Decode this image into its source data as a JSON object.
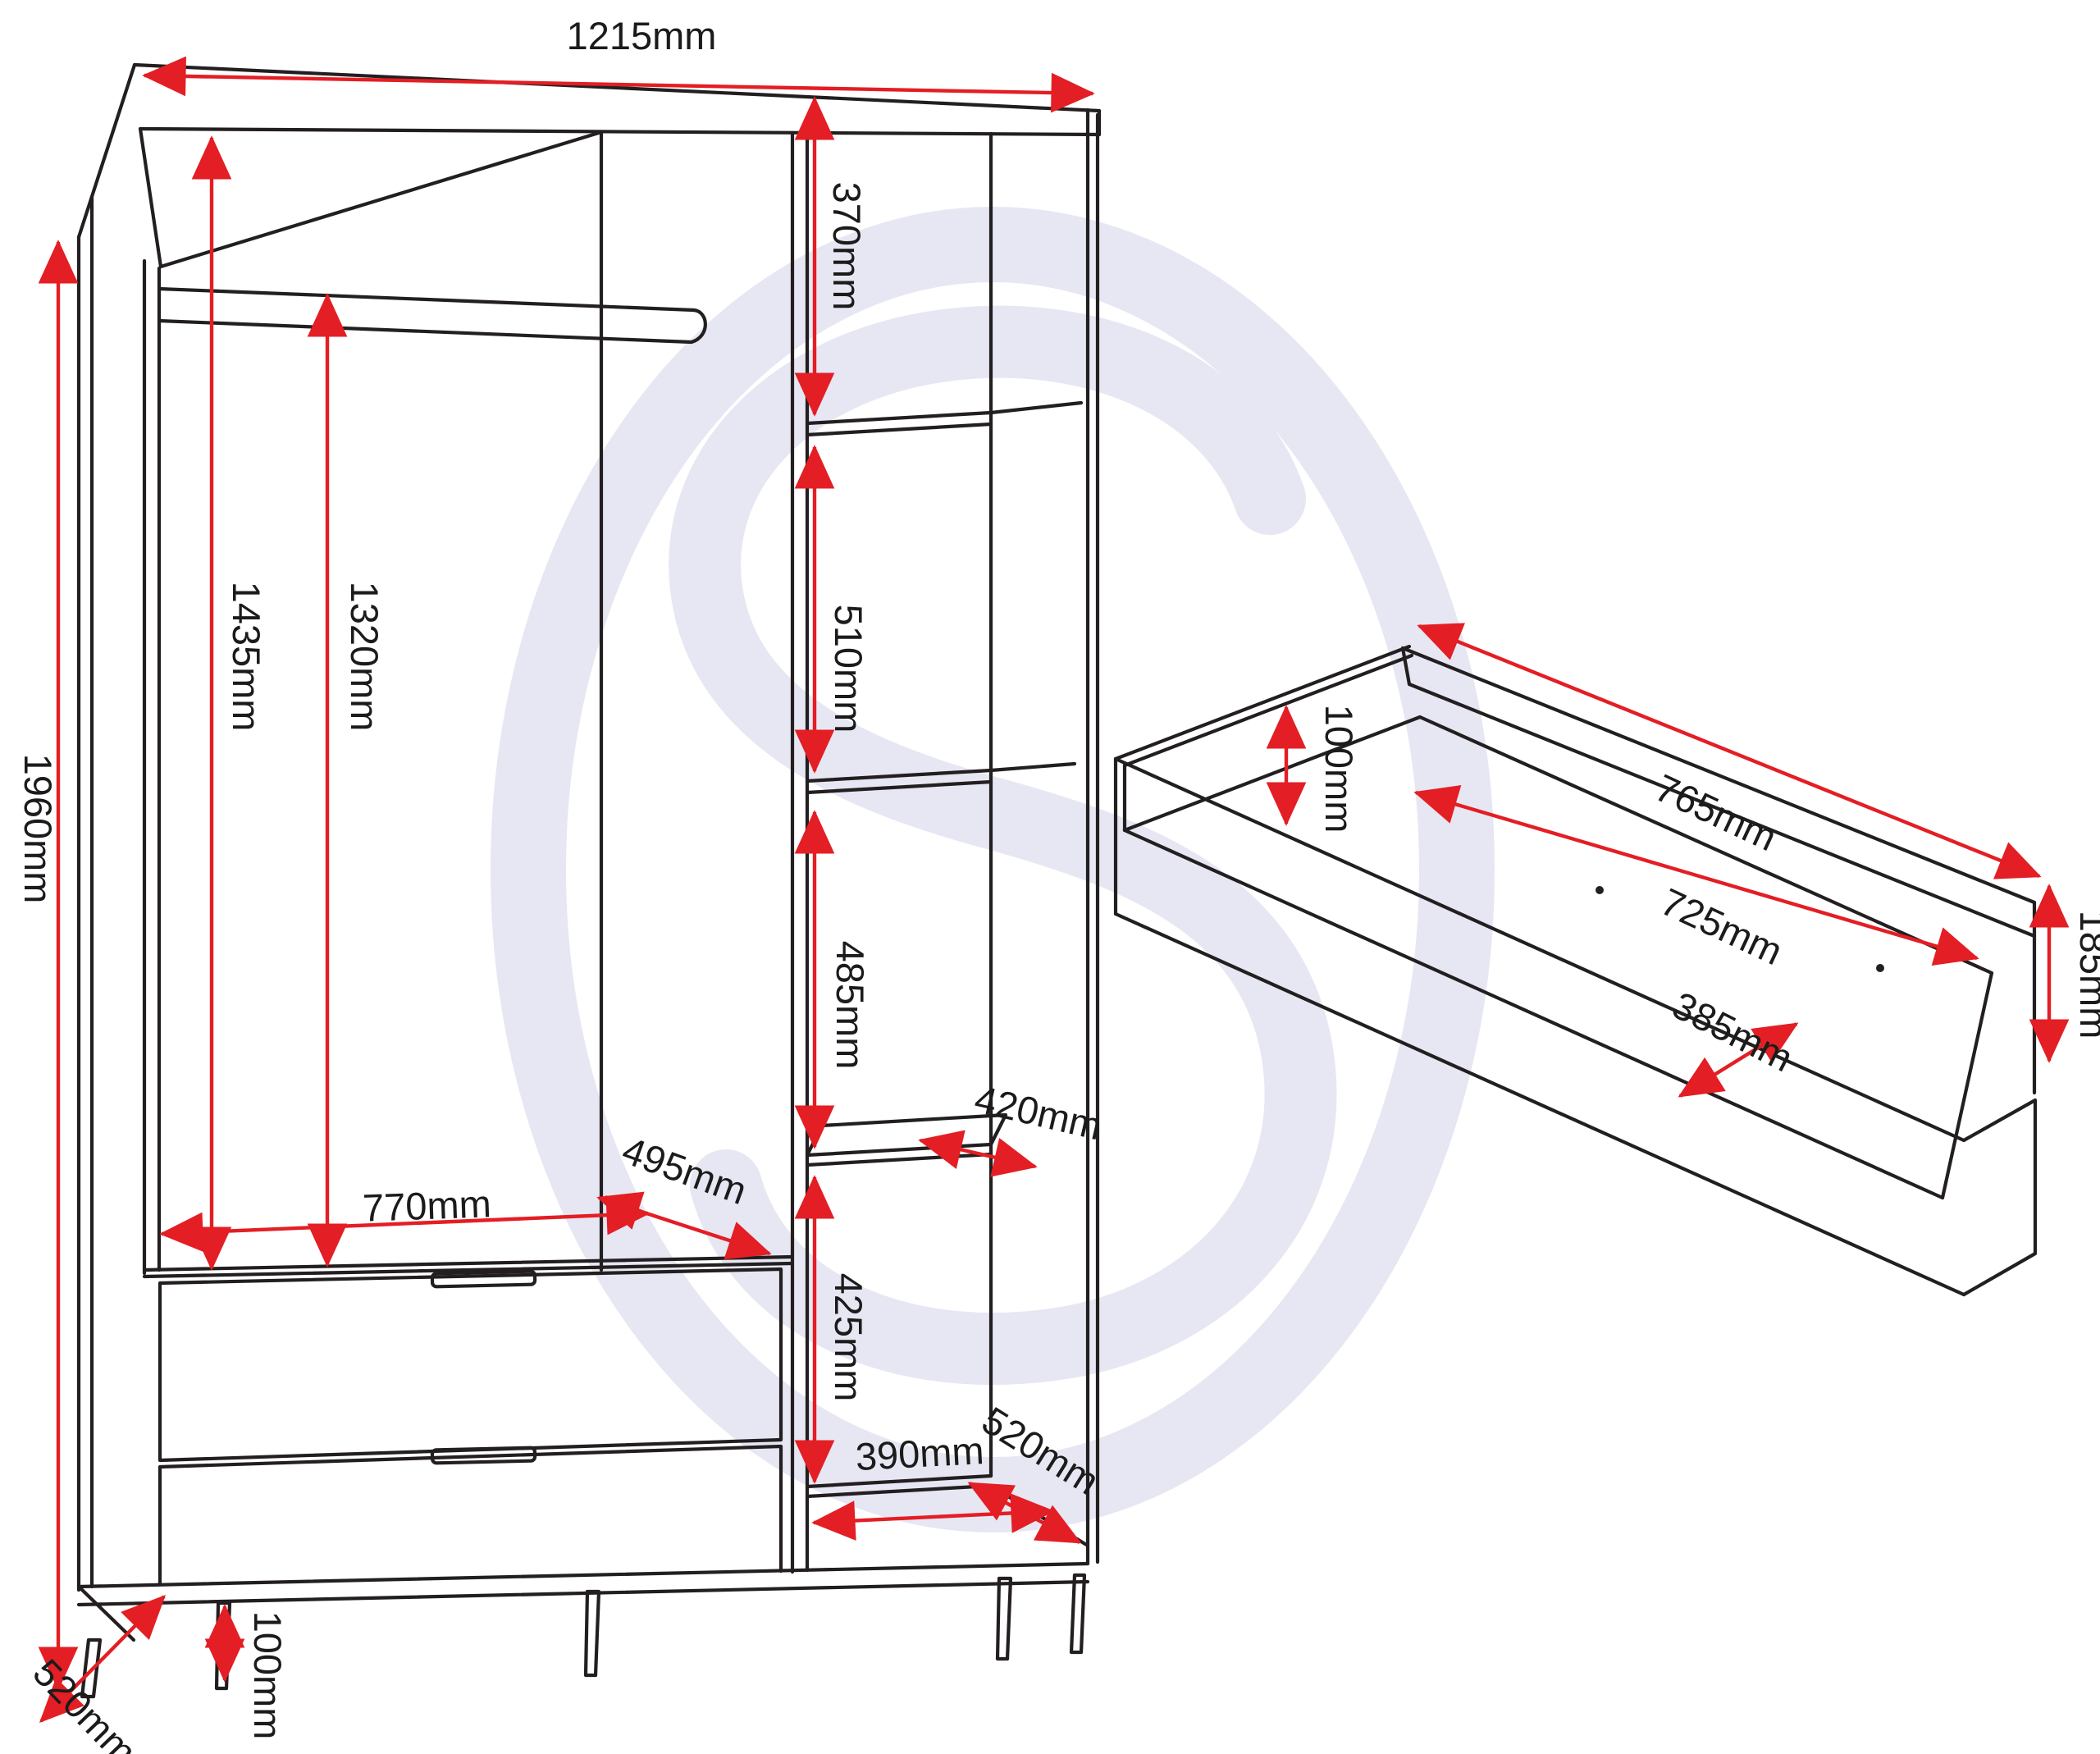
{
  "colors": {
    "dimension_red": "#e31e24",
    "line_black": "#231f20",
    "watermark": "#e7e7f3"
  },
  "watermark": {
    "glyph": "S"
  },
  "dims": {
    "width_top": "1215mm",
    "height_total": "1960mm",
    "interior_height": "1435mm",
    "rail_height": "1320mm",
    "sec1": "370mm",
    "sec2": "510mm",
    "sec3": "485mm",
    "sec4": "425mm",
    "shelf_depth": "420mm",
    "drawer_width": "770mm",
    "drawer_depth": "495mm",
    "base_width": "390mm",
    "depth_left": "520mm",
    "depth_right": "520mm",
    "leg_height": "100mm",
    "dd_back_width": "765mm",
    "dd_inner_width": "725mm",
    "dd_inner_height": "100mm",
    "dd_inner_depth": "385mm",
    "dd_back_height": "185mm"
  }
}
